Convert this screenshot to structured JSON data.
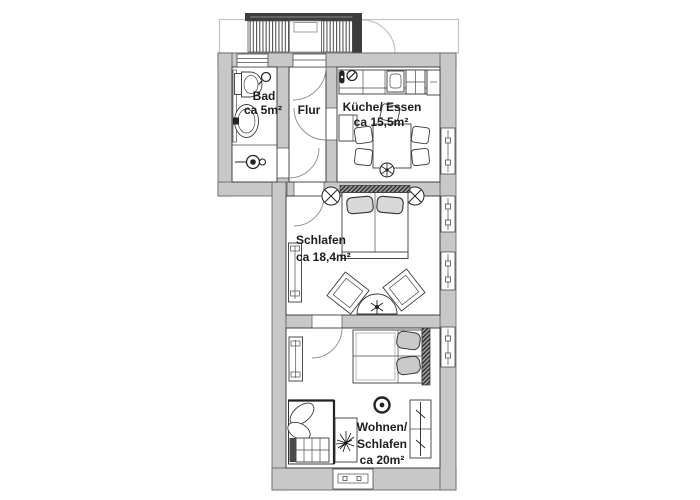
{
  "floorplan": {
    "rooms": {
      "bad": {
        "name": "Bad",
        "area": "ca 5m²"
      },
      "flur": {
        "name": "Flur"
      },
      "kueche": {
        "name": "Küche/ Essen",
        "area": "ca 15,5m²"
      },
      "schlafen": {
        "name": "Schlafen",
        "area": "ca 18,4m²"
      },
      "wohnen": {
        "line1": "Wohnen/",
        "line2": "Schlafen",
        "area": "ca 20m²"
      }
    },
    "colors": {
      "wall": "#c8c8c8",
      "outline": "#3a3a3a",
      "balcony_dark": "#3d3d3d",
      "background": "#ffffff"
    }
  }
}
